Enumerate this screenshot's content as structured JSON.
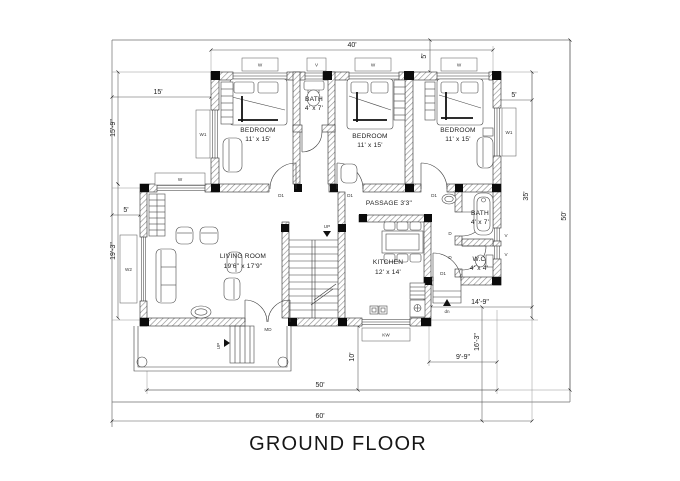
{
  "title": "GROUND FLOOR",
  "rooms": {
    "bedroom1": {
      "name": "BEDROOM",
      "size": "11' x 15'"
    },
    "bedroom2": {
      "name": "BEDROOM",
      "size": "11' x 15'"
    },
    "bedroom3": {
      "name": "BEDROOM",
      "size": "11' x 15'"
    },
    "bath_top": {
      "name": "BATH",
      "size": "4' x 7'"
    },
    "bath_right": {
      "name": "BATH",
      "size": "4' x 7'"
    },
    "wc": {
      "name": "W.C",
      "size": "4' x 4'"
    },
    "passage": {
      "name": "PASSAGE 3'3\""
    },
    "living": {
      "name": "LIVING ROOM",
      "size": "19'6\" x 17'9\""
    },
    "kitchen": {
      "name": "KITCHEN",
      "size": "12' x 14'"
    }
  },
  "dims": {
    "d40": "40'",
    "d5_top": "5'",
    "d5_right": "5'",
    "d15": "15'",
    "d15_9": "15'-9\"",
    "d5_left": "5'",
    "d19_3": "19'-3\"",
    "d35": "35'",
    "d50_right": "50'",
    "d50_bottom": "50'",
    "d60": "60'",
    "d10": "10'",
    "d9_9": "9'-9\"",
    "d16_3": "16'-3\"",
    "d14_9": "14'-9\""
  },
  "labels": {
    "window": "W",
    "window1": "W1",
    "window2": "W2",
    "kitchen_window": "KW",
    "ventilator": "V",
    "door": "D",
    "door1": "D1",
    "main_door": "MD",
    "up": "UP",
    "down": "dn"
  }
}
